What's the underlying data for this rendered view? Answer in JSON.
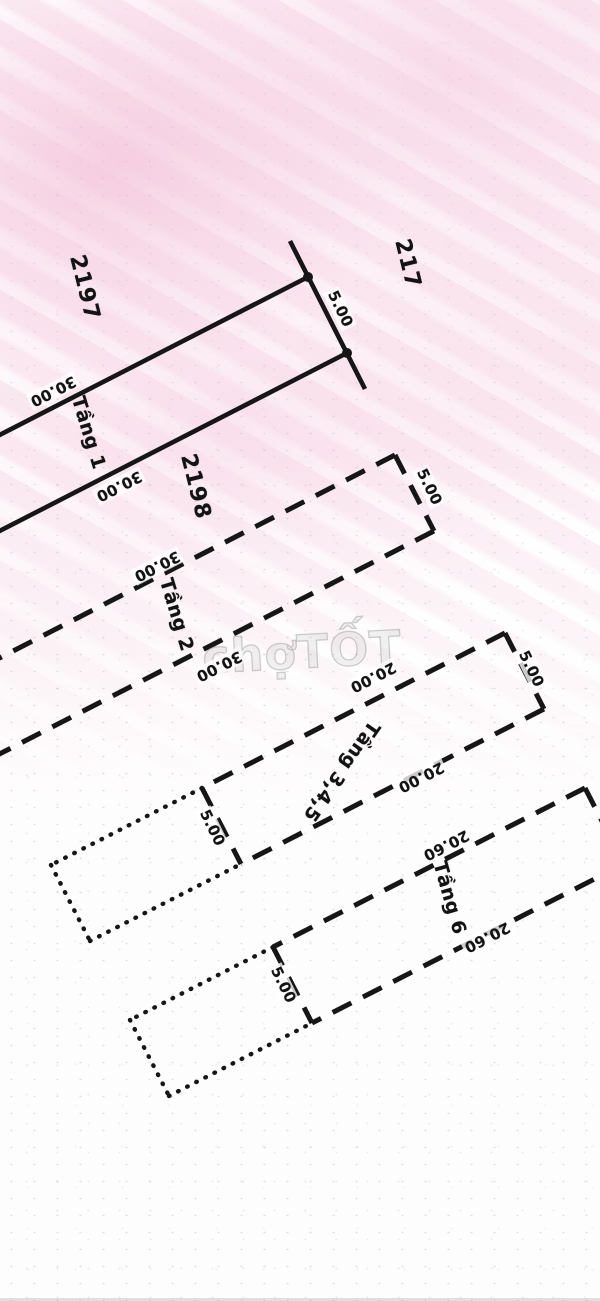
{
  "watermark": "chợTỐT",
  "lots": {
    "left": "2197",
    "right": "217",
    "bottom": "2198"
  },
  "floors": {
    "floor1": {
      "label": "Tầng 1",
      "width_right": "5.00",
      "length_top": "30.00",
      "length_bottom": "30.00"
    },
    "floor2": {
      "label": "Tầng 2",
      "width_right": "5.00",
      "length_top": "30.00",
      "length_bottom": "30.00"
    },
    "floor345": {
      "label": "Tầng 3,4,5",
      "width_right": "5.00",
      "width_left": "5.00",
      "length_top": "20.00",
      "length_bottom": "20.00"
    },
    "floor6": {
      "label": "Tầng 6",
      "width_left": "5.00",
      "length_top": "20.60",
      "length_bottom": "20.60"
    }
  },
  "colors": {
    "ink": "#161616",
    "pink_tint": "#f6d3e4",
    "watermark_gray": "#9c9c9c"
  }
}
